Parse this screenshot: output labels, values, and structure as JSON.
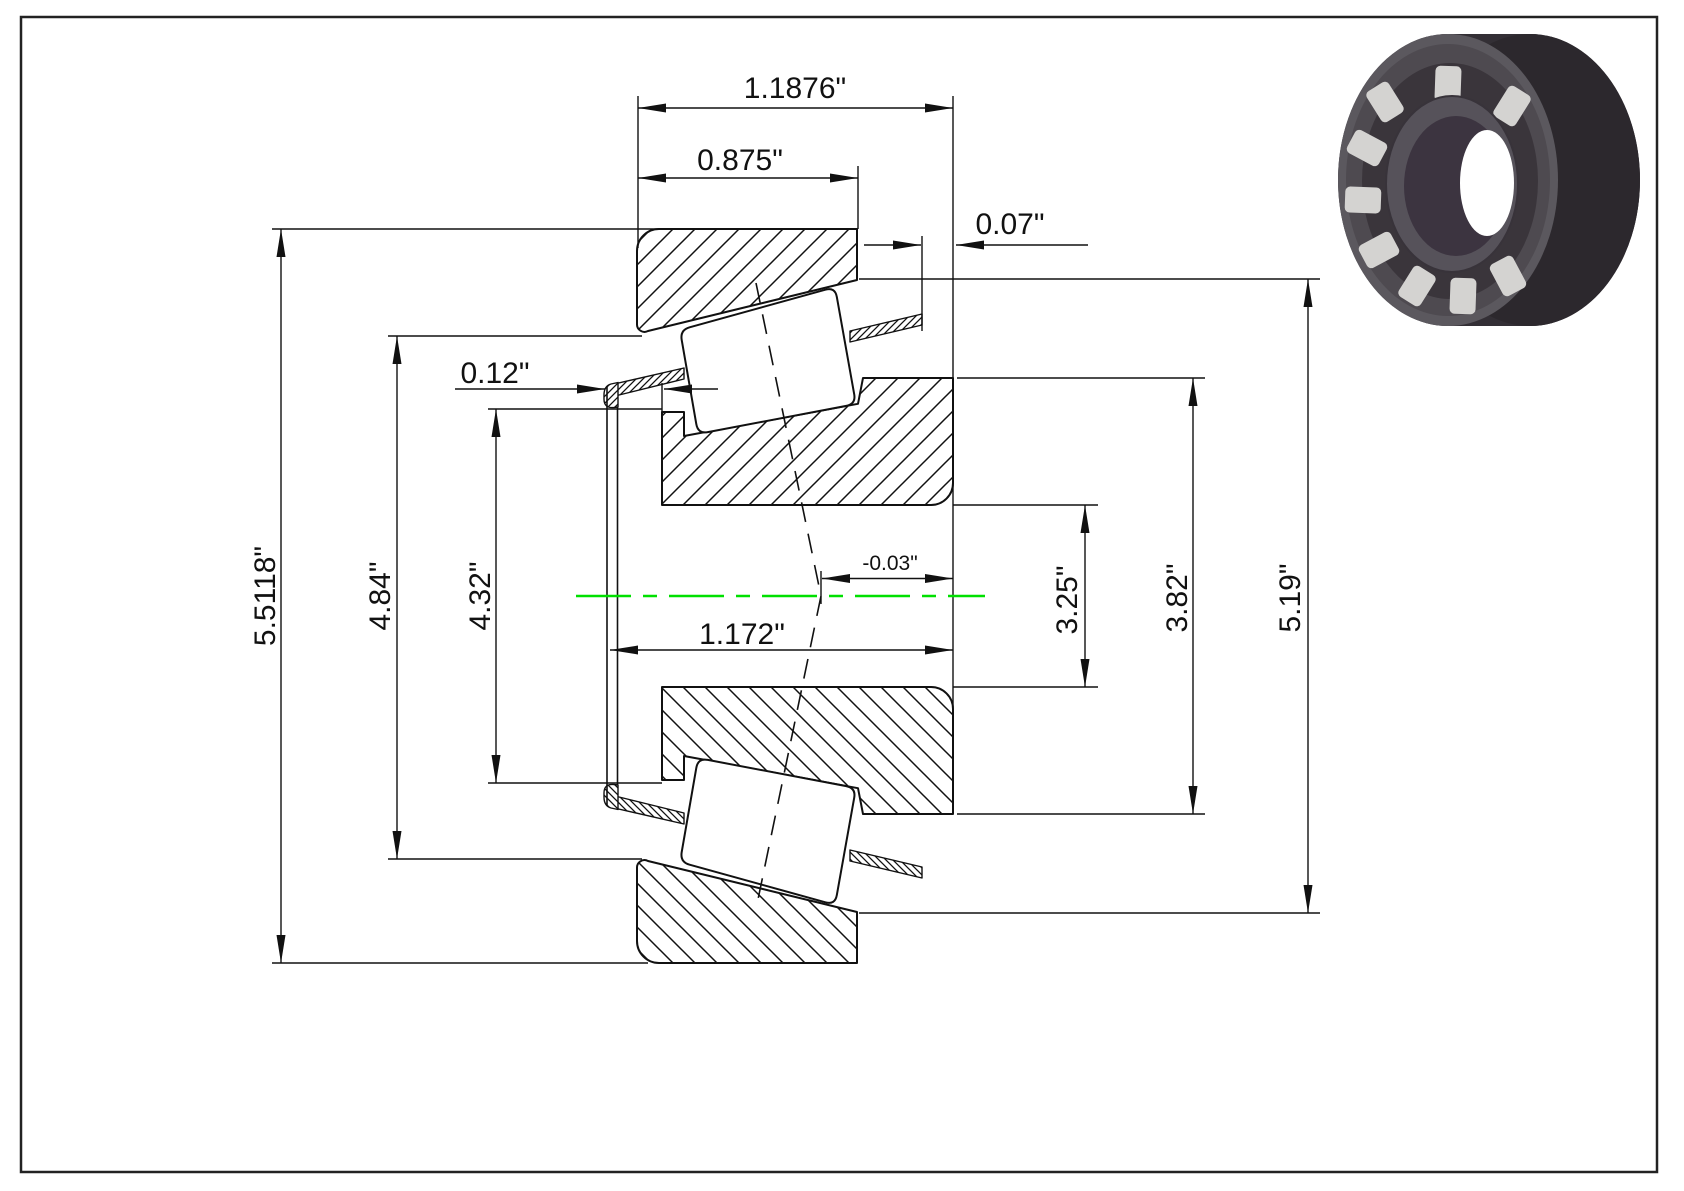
{
  "page": {
    "background": "#ffffff",
    "border_color": "#222222"
  },
  "drawing": {
    "kind": "tapered-roller-bearing-cross-section",
    "centerline_color": "#00e000",
    "line_color": "#111111",
    "dimensions": {
      "overall_width": "1.1876\"",
      "cup_width": "0.875\"",
      "cage_back_protrusion": "0.07\"",
      "cage_front_protrusion": "0.12\"",
      "cup_outer_diameter": "5.5118\"",
      "cup_race_small_diameter": "4.84\"",
      "cone_front_rib_diameter": "4.32\"",
      "cage_overall_width": "1.172\"",
      "effective_center": "-0.03\"",
      "bore_diameter": "3.25\"",
      "cone_back_rib_diameter": "3.82\"",
      "race_large_diameter": "5.19\""
    }
  },
  "bearing_render": {
    "body_color": "#39343a",
    "face_color": "#5b585e",
    "roller_color": "#d4d3d1",
    "bore_color": "#3c3440"
  }
}
